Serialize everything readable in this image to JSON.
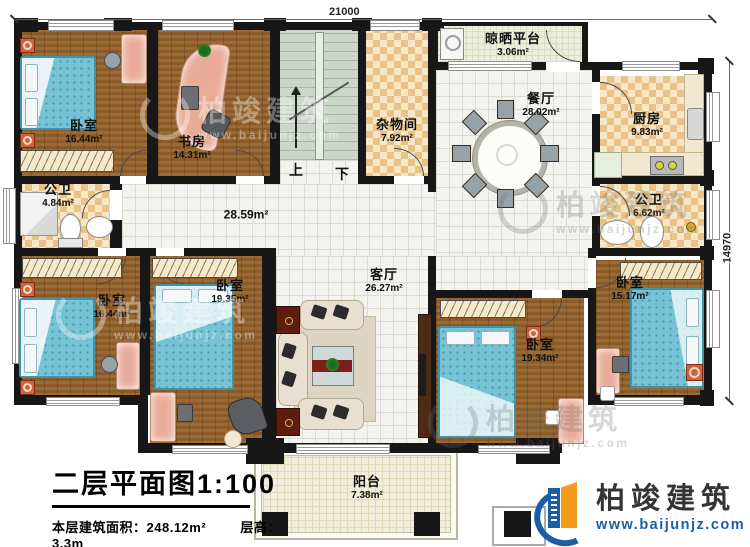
{
  "title_block": {
    "title": "二层平面图1:100",
    "floor_area_label": "本层建筑面积：",
    "floor_area": "248.12m²",
    "story_height_label": "层高：",
    "story_height": "3.3m"
  },
  "dimensions": {
    "width": "21000",
    "height": "14970"
  },
  "stairs": {
    "up": "上",
    "down": "下"
  },
  "rooms": {
    "bedroom_tl": {
      "name": "卧室",
      "area": "16.44m²"
    },
    "study": {
      "name": "书房",
      "area": "14.31m²"
    },
    "bath_l": {
      "name": "公卫",
      "area": "4.84m²"
    },
    "corridor": {
      "area": "28.59m²"
    },
    "storage": {
      "name": "杂物间",
      "area": "7.92m²"
    },
    "platform": {
      "name": "晾晒平台",
      "area": "3.06m²"
    },
    "dining": {
      "name": "餐厅",
      "area": "28.02m²"
    },
    "kitchen": {
      "name": "厨房",
      "area": "9.83m²"
    },
    "bath_r": {
      "name": "公卫",
      "area": "6.62m²"
    },
    "living": {
      "name": "客厅",
      "area": "26.27m²"
    },
    "bedroom_bl": {
      "name": "卧室",
      "area": "16.44m²"
    },
    "bedroom_bm": {
      "name": "卧室",
      "area": "19.35m²"
    },
    "bedroom_bm2": {
      "name": "卧室",
      "area": "19.34m²"
    },
    "bedroom_r": {
      "name": "卧室",
      "area": "15.17m²"
    },
    "balcony": {
      "name": "阳台",
      "area": "7.38m²"
    }
  },
  "brand": {
    "name": "柏竣建筑",
    "website": "www.baijunjz.com"
  },
  "watermark": {
    "name": "柏竣建筑",
    "website": "www.baijunjz.com"
  },
  "colors": {
    "wall": "#171717",
    "wood_floor": "#905f2b",
    "tile_checker": "#e9c28a",
    "white_tile": "#f3f3f0",
    "stairs": "#cdd6cb",
    "bed": "#77c3d6",
    "brand_blue": "#1b5ea6",
    "brand_orange": "#f29b1d"
  }
}
